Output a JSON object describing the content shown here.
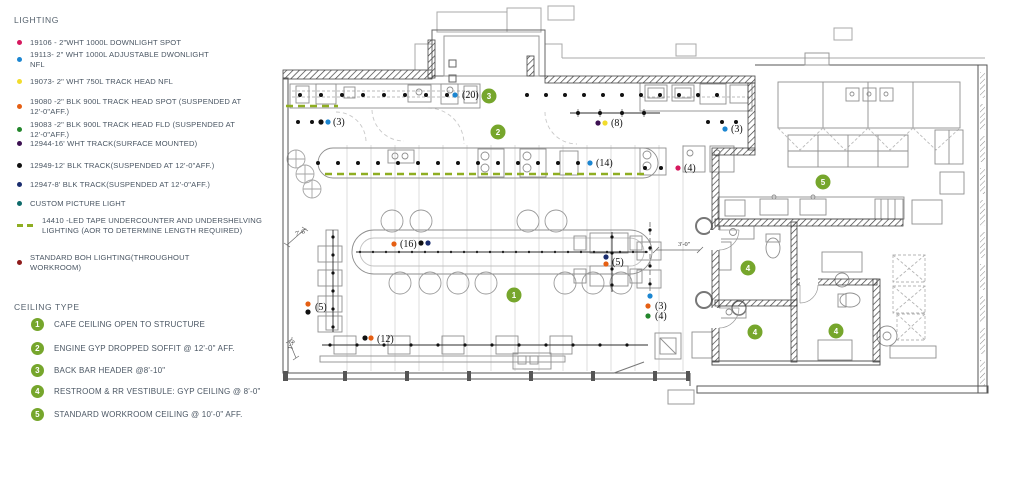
{
  "colors": {
    "pink": "#d6185e",
    "blue": "#1c86d1",
    "yellow": "#f2dc2c",
    "orange": "#e55f13",
    "green": "#23862c",
    "purple": "#3d1152",
    "black": "#111111",
    "navy": "#1a2d6e",
    "teal": "#0f6b6b",
    "led": "#8fae22",
    "boh_red": "#8e1b1b",
    "tag_green": "#76a62c"
  },
  "legend": {
    "lighting": {
      "title": "LIGHTING",
      "items": [
        {
          "marker": "dot",
          "color": "#d6185e",
          "lines": [
            "19106 - 2\"WHT 1000L DOWNLIGHT SPOT"
          ]
        },
        {
          "marker": "dot",
          "color": "#1c86d1",
          "lines": [
            "19113- 2\" WHT 1000L ADJUSTABLE DWONLIGHT",
            "NFL"
          ]
        },
        {
          "marker": "dot",
          "color": "#f2dc2c",
          "lines": [
            "19073- 2\" WHT 750L TRACK HEAD NFL"
          ]
        },
        {
          "marker": "dot",
          "color": "#e55f13",
          "lines": [
            "19080 -2\" BLK 900L TRACK HEAD SPOT (SUSPENDED AT",
            "12'-0\"AFF.)"
          ]
        },
        {
          "marker": "dot",
          "color": "#23862c",
          "lines": [
            "19083 -2\" BLK 900L TRACK HEAD FLD (SUSPENDED AT",
            "12'-0\"AFF.)"
          ]
        },
        {
          "marker": "dot",
          "color": "#3d1152",
          "lines": [
            "12944-16' WHT TRACK(SURFACE MOUNTED)"
          ]
        },
        {
          "marker": "dot",
          "color": "#111111",
          "lines": [
            "12949-12' BLK TRACK(SUSPENDED AT 12'-0\"AFF.)"
          ]
        },
        {
          "marker": "dot",
          "color": "#1a2d6e",
          "lines": [
            "12947-8' BLK TRACK(SUSPENDED AT 12'-0\"AFF.)"
          ]
        },
        {
          "marker": "dot",
          "color": "#0f6b6b",
          "lines": [
            "CUSTOM PICTURE LIGHT"
          ]
        },
        {
          "marker": "dashes",
          "color": "#8fae22",
          "lines": [
            "14410 -LED TAPE UNDERCOUNTER AND UNDERSHELVING",
            "LIGHTING (AOR TO DETERMINE LENGTH REQUIRED)"
          ]
        },
        {
          "marker": "dot",
          "color": "#8e1b1b",
          "lines": [
            "STANDARD BOH LIGHTING(THROUGHOUT",
            "WORKROOM)"
          ]
        }
      ]
    },
    "ceiling": {
      "title": "CEILING TYPE",
      "tag_color": "#76a62c",
      "items": [
        {
          "num": "1",
          "label": "CAFE CEILING OPEN TO STRUCTURE"
        },
        {
          "num": "2",
          "label": "ENGINE GYP DROPPED SOFFIT @ 12'-0\" AFF."
        },
        {
          "num": "3",
          "label": "BACK BAR HEADER @8'-10\""
        },
        {
          "num": "4",
          "label": "RESTROOM & RR VESTIBULE: GYP CEILING @ 8'-0\""
        },
        {
          "num": "5",
          "label": "STANDARD WORKROOM  CEILING @ 10'-0\" AFF."
        }
      ]
    }
  },
  "plan": {
    "callouts": [
      {
        "label": "(20)",
        "x": 462,
        "y": 98,
        "dots": [
          {
            "x": 455,
            "y": 95,
            "c": "#1c86d1"
          }
        ]
      },
      {
        "label": "(3)",
        "x": 333,
        "y": 125,
        "dots": [
          {
            "x": 321,
            "y": 122,
            "c": "#111111"
          },
          {
            "x": 328,
            "y": 122,
            "c": "#1c86d1"
          }
        ]
      },
      {
        "label": "(8)",
        "x": 611,
        "y": 126,
        "dots": [
          {
            "x": 598,
            "y": 123,
            "c": "#3d1152"
          },
          {
            "x": 605,
            "y": 123,
            "c": "#f2dc2c"
          }
        ]
      },
      {
        "label": "(3)",
        "x": 731,
        "y": 132,
        "dots": [
          {
            "x": 725,
            "y": 129,
            "c": "#1c86d1"
          }
        ]
      },
      {
        "label": "(14)",
        "x": 596,
        "y": 166,
        "dots": [
          {
            "x": 590,
            "y": 163,
            "c": "#1c86d1"
          }
        ]
      },
      {
        "label": "(4)",
        "x": 684,
        "y": 171,
        "dots": [
          {
            "x": 678,
            "y": 168,
            "c": "#d6185e"
          }
        ]
      },
      {
        "label": "(16)",
        "x": 400,
        "y": 247,
        "dots": [
          {
            "x": 394,
            "y": 244,
            "c": "#e55f13"
          },
          {
            "x": 421,
            "y": 243,
            "c": "#111111"
          },
          {
            "x": 428,
            "y": 243,
            "c": "#1a2d6e"
          }
        ]
      },
      {
        "label": "(5)",
        "x": 612,
        "y": 265,
        "dots": [
          {
            "x": 606,
            "y": 257,
            "c": "#1a2d6e"
          },
          {
            "x": 606,
            "y": 264,
            "c": "#e55f13"
          }
        ]
      },
      {
        "label": "",
        "x": 0,
        "y": 0,
        "dots": [
          {
            "x": 650,
            "y": 296,
            "c": "#1c86d1"
          }
        ]
      },
      {
        "label": "(3)",
        "x": 655,
        "y": 309,
        "dots": [
          {
            "x": 648,
            "y": 306,
            "c": "#e55f13"
          }
        ]
      },
      {
        "label": "(4)",
        "x": 655,
        "y": 319,
        "dots": [
          {
            "x": 648,
            "y": 316,
            "c": "#23862c"
          }
        ]
      },
      {
        "label": "(5)",
        "x": 315,
        "y": 310,
        "dots": [
          {
            "x": 308,
            "y": 304,
            "c": "#e55f13"
          },
          {
            "x": 308,
            "y": 312,
            "c": "#111111"
          }
        ]
      },
      {
        "label": "(12)",
        "x": 377,
        "y": 342,
        "dots": [
          {
            "x": 365,
            "y": 338,
            "c": "#111111"
          },
          {
            "x": 371,
            "y": 338,
            "c": "#e55f13"
          }
        ]
      }
    ],
    "ceiling_tags": [
      {
        "num": "3",
        "x": 489,
        "y": 96
      },
      {
        "num": "2",
        "x": 498,
        "y": 132
      },
      {
        "num": "1",
        "x": 514,
        "y": 295
      },
      {
        "num": "5",
        "x": 823,
        "y": 182
      },
      {
        "num": "4",
        "x": 748,
        "y": 268
      },
      {
        "num": "4",
        "x": 755,
        "y": 332
      },
      {
        "num": "4",
        "x": 836,
        "y": 331
      }
    ],
    "dimensions": [
      {
        "label": "7'-6\"",
        "x": 296,
        "y": 236,
        "rot": -18
      },
      {
        "label": "3'-0\"",
        "x": 678,
        "y": 246,
        "rot": 0
      },
      {
        "label": "1'-6\"",
        "x": 292,
        "y": 350,
        "rot": -72
      }
    ],
    "light_rows": [
      {
        "x": 300,
        "y": 95,
        "dx": 21,
        "n": 8,
        "c": "#111111",
        "r": 2
      },
      {
        "x": 527,
        "y": 95,
        "dx": 19,
        "n": 11,
        "c": "#111111",
        "r": 2
      },
      {
        "x": 298,
        "y": 122,
        "dx": 14,
        "n": 2,
        "c": "#111111",
        "r": 2
      },
      {
        "x": 318,
        "y": 163,
        "dx": 20,
        "n": 14,
        "c": "#111111",
        "r": 2
      },
      {
        "x": 645,
        "y": 168,
        "dx": 16,
        "n": 2,
        "c": "#111111",
        "r": 2
      },
      {
        "x": 578,
        "y": 113,
        "dx": 22,
        "n": 4,
        "c": "#111111",
        "r": 2
      },
      {
        "x": 708,
        "y": 122,
        "dx": 14,
        "n": 3,
        "c": "#111111",
        "r": 2
      },
      {
        "x": 360,
        "y": 252,
        "dx": 13,
        "n": 23,
        "c": "#222222",
        "r": 1.2
      },
      {
        "x": 330,
        "y": 345,
        "dx": 27,
        "n": 12,
        "c": "#111111",
        "r": 1.6
      },
      {
        "x": 333,
        "y": 237,
        "dy": 18,
        "n": 6,
        "c": "#111111",
        "r": 1.6
      },
      {
        "x": 612,
        "y": 237,
        "dy": 16,
        "n": 4,
        "c": "#111111",
        "r": 1.6
      },
      {
        "x": 650,
        "y": 230,
        "dy": 18,
        "n": 4,
        "c": "#111111",
        "r": 1.6
      }
    ],
    "led_runs": [
      {
        "x1": 286,
        "y1": 106,
        "x2": 338,
        "y2": 106
      },
      {
        "x1": 325,
        "y1": 174,
        "x2": 646,
        "y2": 174
      }
    ]
  }
}
